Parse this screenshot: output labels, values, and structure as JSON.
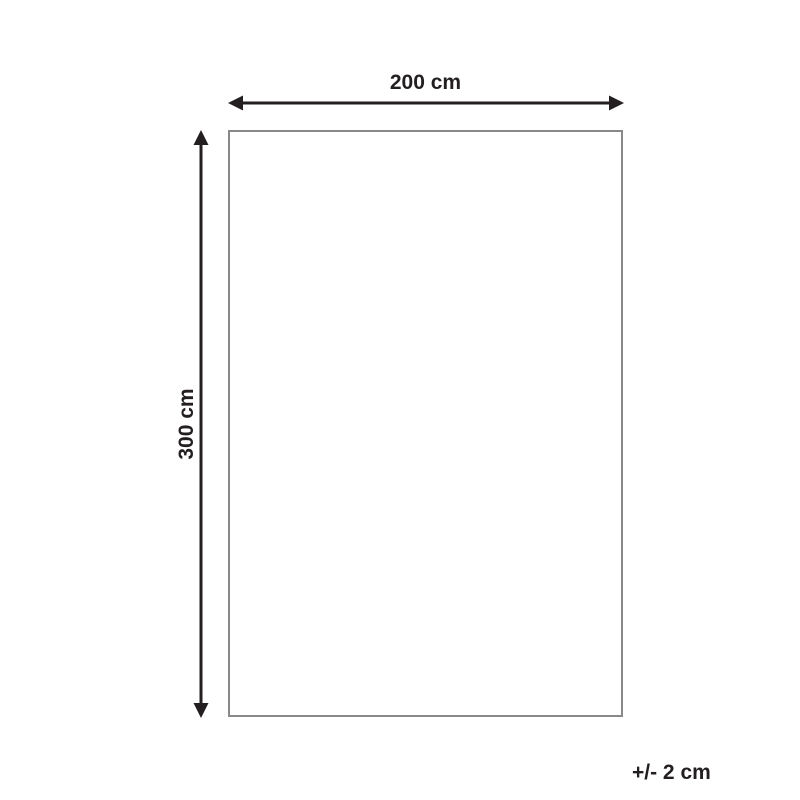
{
  "diagram": {
    "title": "product-dimension-diagram",
    "width_label": "200 cm",
    "height_label": "300 cm",
    "tolerance_label": "+/- 2 cm",
    "colors": {
      "arrow": "#231f20",
      "text": "#231f20",
      "rectangle_border": "#88898b",
      "background": "#ffffff"
    }
  }
}
